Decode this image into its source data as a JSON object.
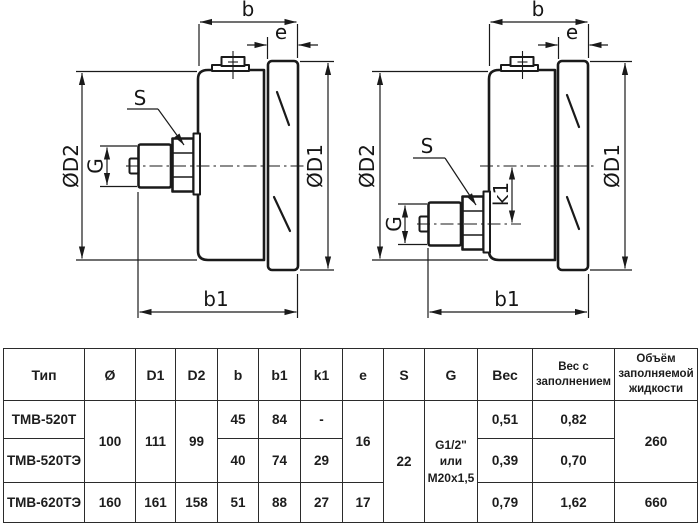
{
  "drawings": {
    "left": {
      "name": "gauge-back-connection-centered",
      "labels": {
        "b": "b",
        "e": "e",
        "s": "S",
        "d2": "ØD2",
        "g": "G",
        "d1": "ØD1",
        "b1": "b1"
      }
    },
    "right": {
      "name": "gauge-back-connection-offset",
      "labels": {
        "b": "b",
        "e": "e",
        "s": "S",
        "d2": "ØD2",
        "g": "G",
        "k1": "k1",
        "d1": "ØD1",
        "b1": "b1"
      }
    },
    "ink_color": "#1a1a1a"
  },
  "table": {
    "headers": [
      "Тип",
      "Ø",
      "D1",
      "D2",
      "b",
      "b1",
      "k1",
      "e",
      "S",
      "G",
      "Вес",
      "Вес с заполнением",
      "Объём заполняемой жидкости"
    ],
    "merged": {
      "diameter": "100",
      "d1": "111",
      "d2": "99",
      "e": "16",
      "s": "22",
      "g": "G1/2\"\nили\nM20x1,5",
      "volume": "260"
    },
    "rows": [
      {
        "type": "ТМВ-520Т",
        "b": "45",
        "b1": "84",
        "k1": "-",
        "weight": "0,51",
        "weight_filled": "0,82"
      },
      {
        "type": "ТМВ-520ТЭ",
        "b": "40",
        "b1": "74",
        "k1": "29",
        "weight": "0,39",
        "weight_filled": "0,70"
      },
      {
        "type": "ТМВ-620ТЭ",
        "diameter": "160",
        "d1": "161",
        "d2": "158",
        "b": "51",
        "b1": "88",
        "k1": "27",
        "e": "17",
        "weight": "0,79",
        "weight_filled": "1,62",
        "volume": "660"
      }
    ]
  }
}
